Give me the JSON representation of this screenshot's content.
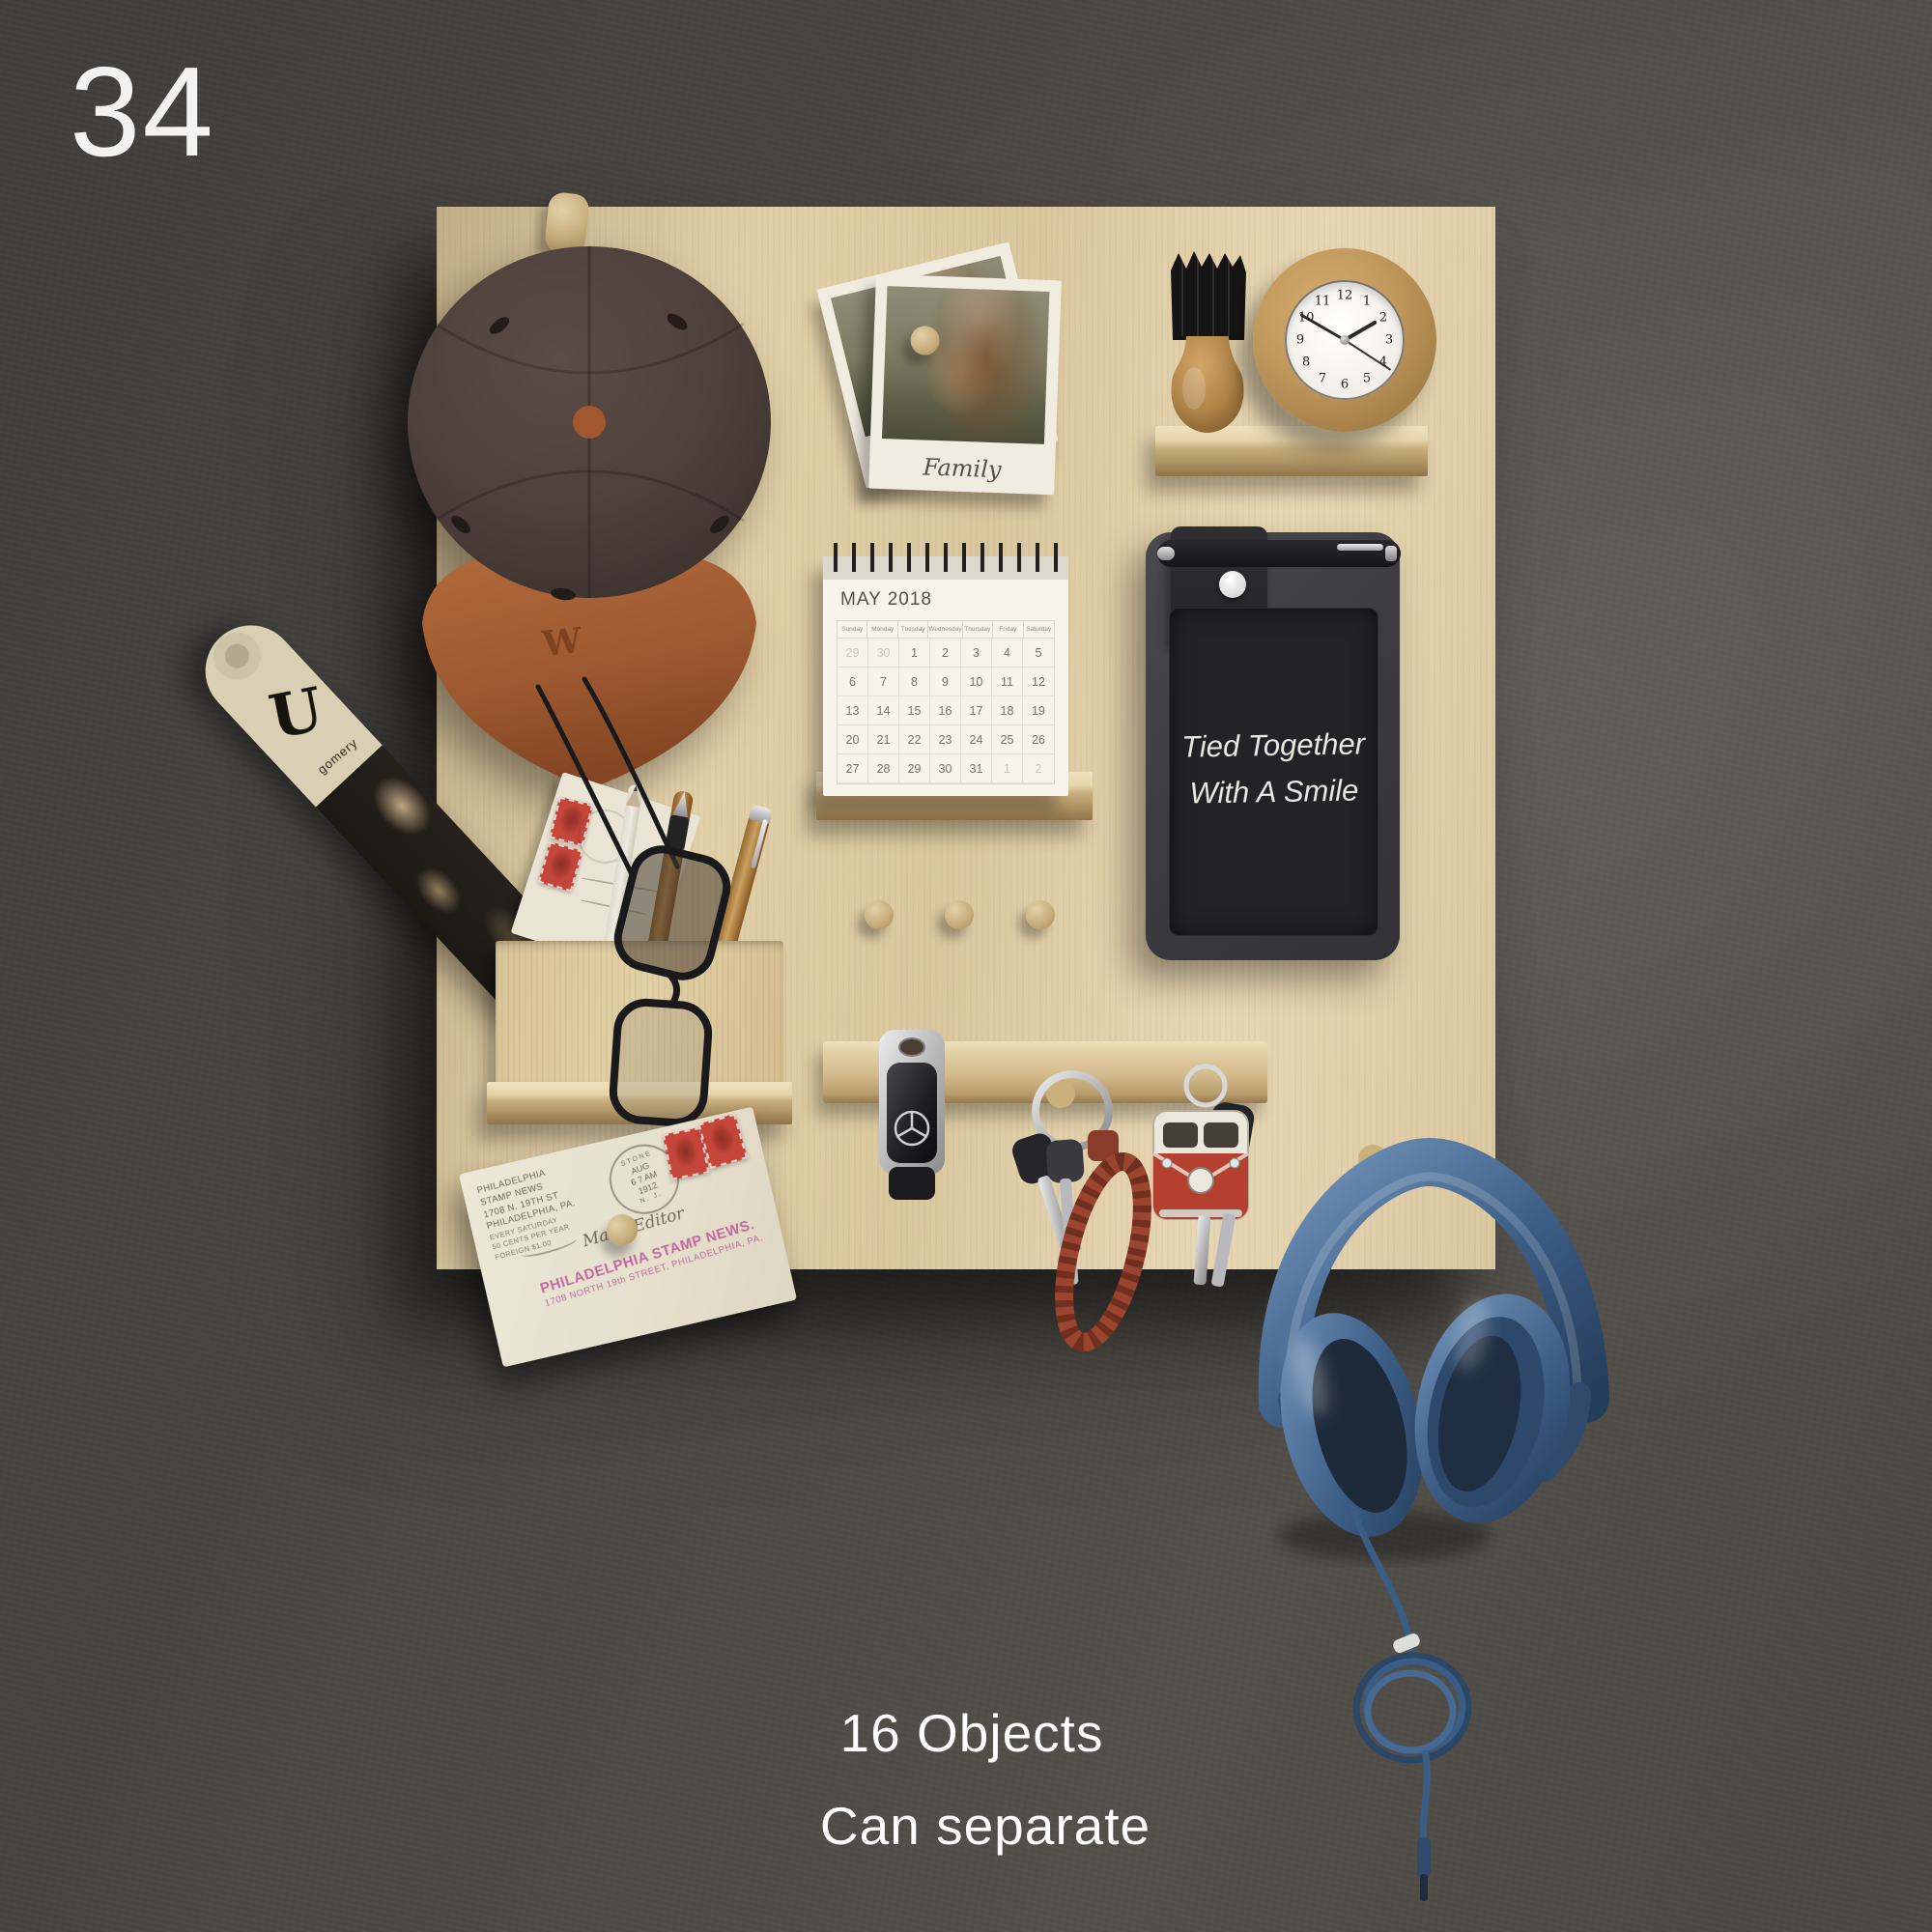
{
  "scene": {
    "number": "34",
    "captions": [
      "16 Objects",
      "Can separate"
    ]
  },
  "cap": {
    "monogram": "W"
  },
  "polaroid": {
    "caption": "Family"
  },
  "calendar": {
    "title": "MAY 2018",
    "weekdays": [
      "Sunday",
      "Monday",
      "Tuesday",
      "Wednesday",
      "Thursday",
      "Friday",
      "Saturday"
    ],
    "cells": [
      {
        "d": "29",
        "out": true
      },
      {
        "d": "30",
        "out": true
      },
      {
        "d": "1"
      },
      {
        "d": "2"
      },
      {
        "d": "3"
      },
      {
        "d": "4"
      },
      {
        "d": "5"
      },
      {
        "d": "6"
      },
      {
        "d": "7"
      },
      {
        "d": "8"
      },
      {
        "d": "9"
      },
      {
        "d": "10"
      },
      {
        "d": "11"
      },
      {
        "d": "12"
      },
      {
        "d": "13"
      },
      {
        "d": "14"
      },
      {
        "d": "15"
      },
      {
        "d": "16"
      },
      {
        "d": "17"
      },
      {
        "d": "18"
      },
      {
        "d": "19"
      },
      {
        "d": "20"
      },
      {
        "d": "21"
      },
      {
        "d": "22"
      },
      {
        "d": "23"
      },
      {
        "d": "24"
      },
      {
        "d": "25"
      },
      {
        "d": "26"
      },
      {
        "d": "27"
      },
      {
        "d": "28"
      },
      {
        "d": "29"
      },
      {
        "d": "30"
      },
      {
        "d": "31"
      },
      {
        "d": "1",
        "out": true
      },
      {
        "d": "2",
        "out": true
      }
    ]
  },
  "clock": {
    "numerals": [
      "12",
      "1",
      "2",
      "3",
      "4",
      "5",
      "6",
      "7",
      "8",
      "9",
      "10",
      "11"
    ],
    "hour_angle_deg": 60,
    "minute_angle_deg": 300,
    "second_angle_deg": 123
  },
  "tablet": {
    "text_lines": [
      "Tied Together",
      "With A Smile"
    ]
  },
  "newspaper": {
    "masthead_initial": "U",
    "subtext": "gomery"
  },
  "envelope": {
    "corner_card": [
      "PHILADELPHIA",
      "STAMP NEWS",
      "1708 N. 19TH ST",
      "PHILADELPHIA, PA."
    ],
    "corner_card_small": [
      "EVERY SATURDAY",
      "50 CENTS PER YEAR",
      "FOREIGN $1.00"
    ],
    "postmark_arc": "STONE",
    "postmark_lines": [
      "AUG",
      "6",
      "7 AM",
      "1912"
    ],
    "postmark_state": "N. J.",
    "address_script": "Main, Editor",
    "rubber_stamp_lines": [
      "PHILADELPHIA STAMP NEWS.",
      "1708 NORTH 19th STREET, PHILADELPHIA, PA."
    ]
  },
  "colors": {
    "wall": "#4a4641",
    "board_wood": "#ddc99e",
    "cap_crown": "#4e403b",
    "cap_brim": "#a15c31",
    "headphones_blue": "#3d5f86",
    "cable_blue": "#3a5d85",
    "stamp_red": "#c4453a",
    "braid_red": "#9b4530",
    "vw_red": "#b5402f",
    "tablet_body": "#3f3f42",
    "tablet_screen": "#232326"
  }
}
